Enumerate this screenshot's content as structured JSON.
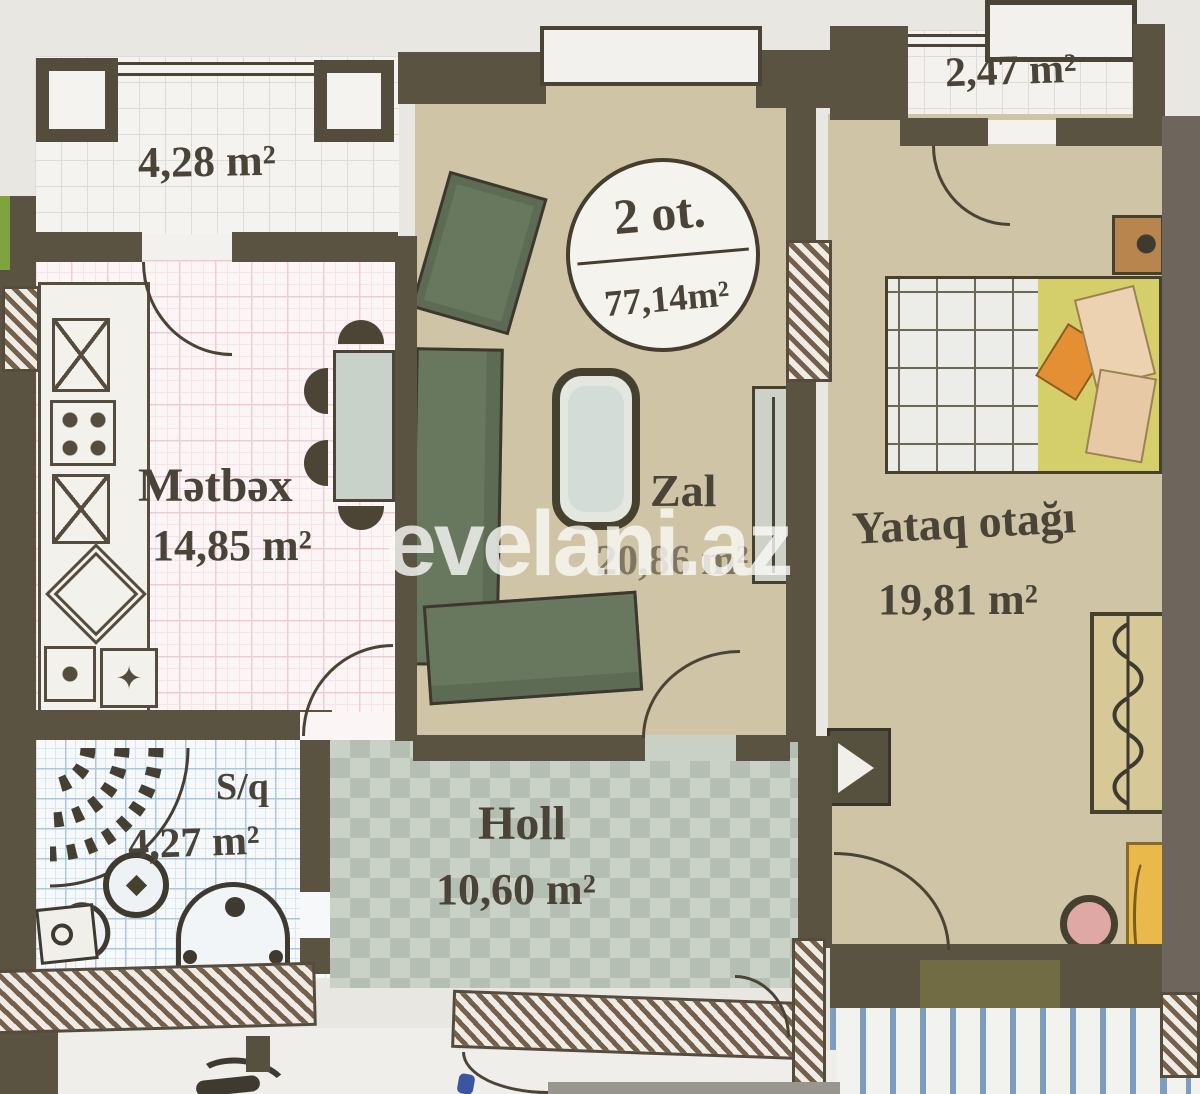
{
  "watermark": {
    "text": "evelani.az"
  },
  "badge": {
    "top": "2 ot.",
    "bottom": "77,14m²"
  },
  "rooms": {
    "balcony_left": {
      "area": "4,28 m²"
    },
    "balcony_right": {
      "area": "2,47 m²"
    },
    "kitchen": {
      "name": "Mətbəx",
      "area": "14,85 m²"
    },
    "living_room": {
      "name": "Zal",
      "area": "20,86 m²"
    },
    "bedroom": {
      "name": "Yataq otağı",
      "area": "19,81 m²"
    },
    "bathroom": {
      "name": "S/q",
      "area": "4,27 m²"
    },
    "hall": {
      "name": "Holl",
      "area": "10,60 m²"
    }
  },
  "icons": {
    "flower_star": "✦"
  },
  "colors": {
    "wall": "#5b5342",
    "hatched_wall_line": "#75604c",
    "floor_beige": "#cfc4a6",
    "kitchen_grid_pink": "#f0cdd6",
    "bathroom_grid_blue": "#a9c8de",
    "hall_tile_green": "#b4beb3",
    "sofa_green": "#68785f",
    "pillow_orange": "#e58f35",
    "desk_yellow": "#e9b94b",
    "watermark_white": "rgba(250,250,246,0.8)",
    "label_ink": "#4a4337"
  }
}
